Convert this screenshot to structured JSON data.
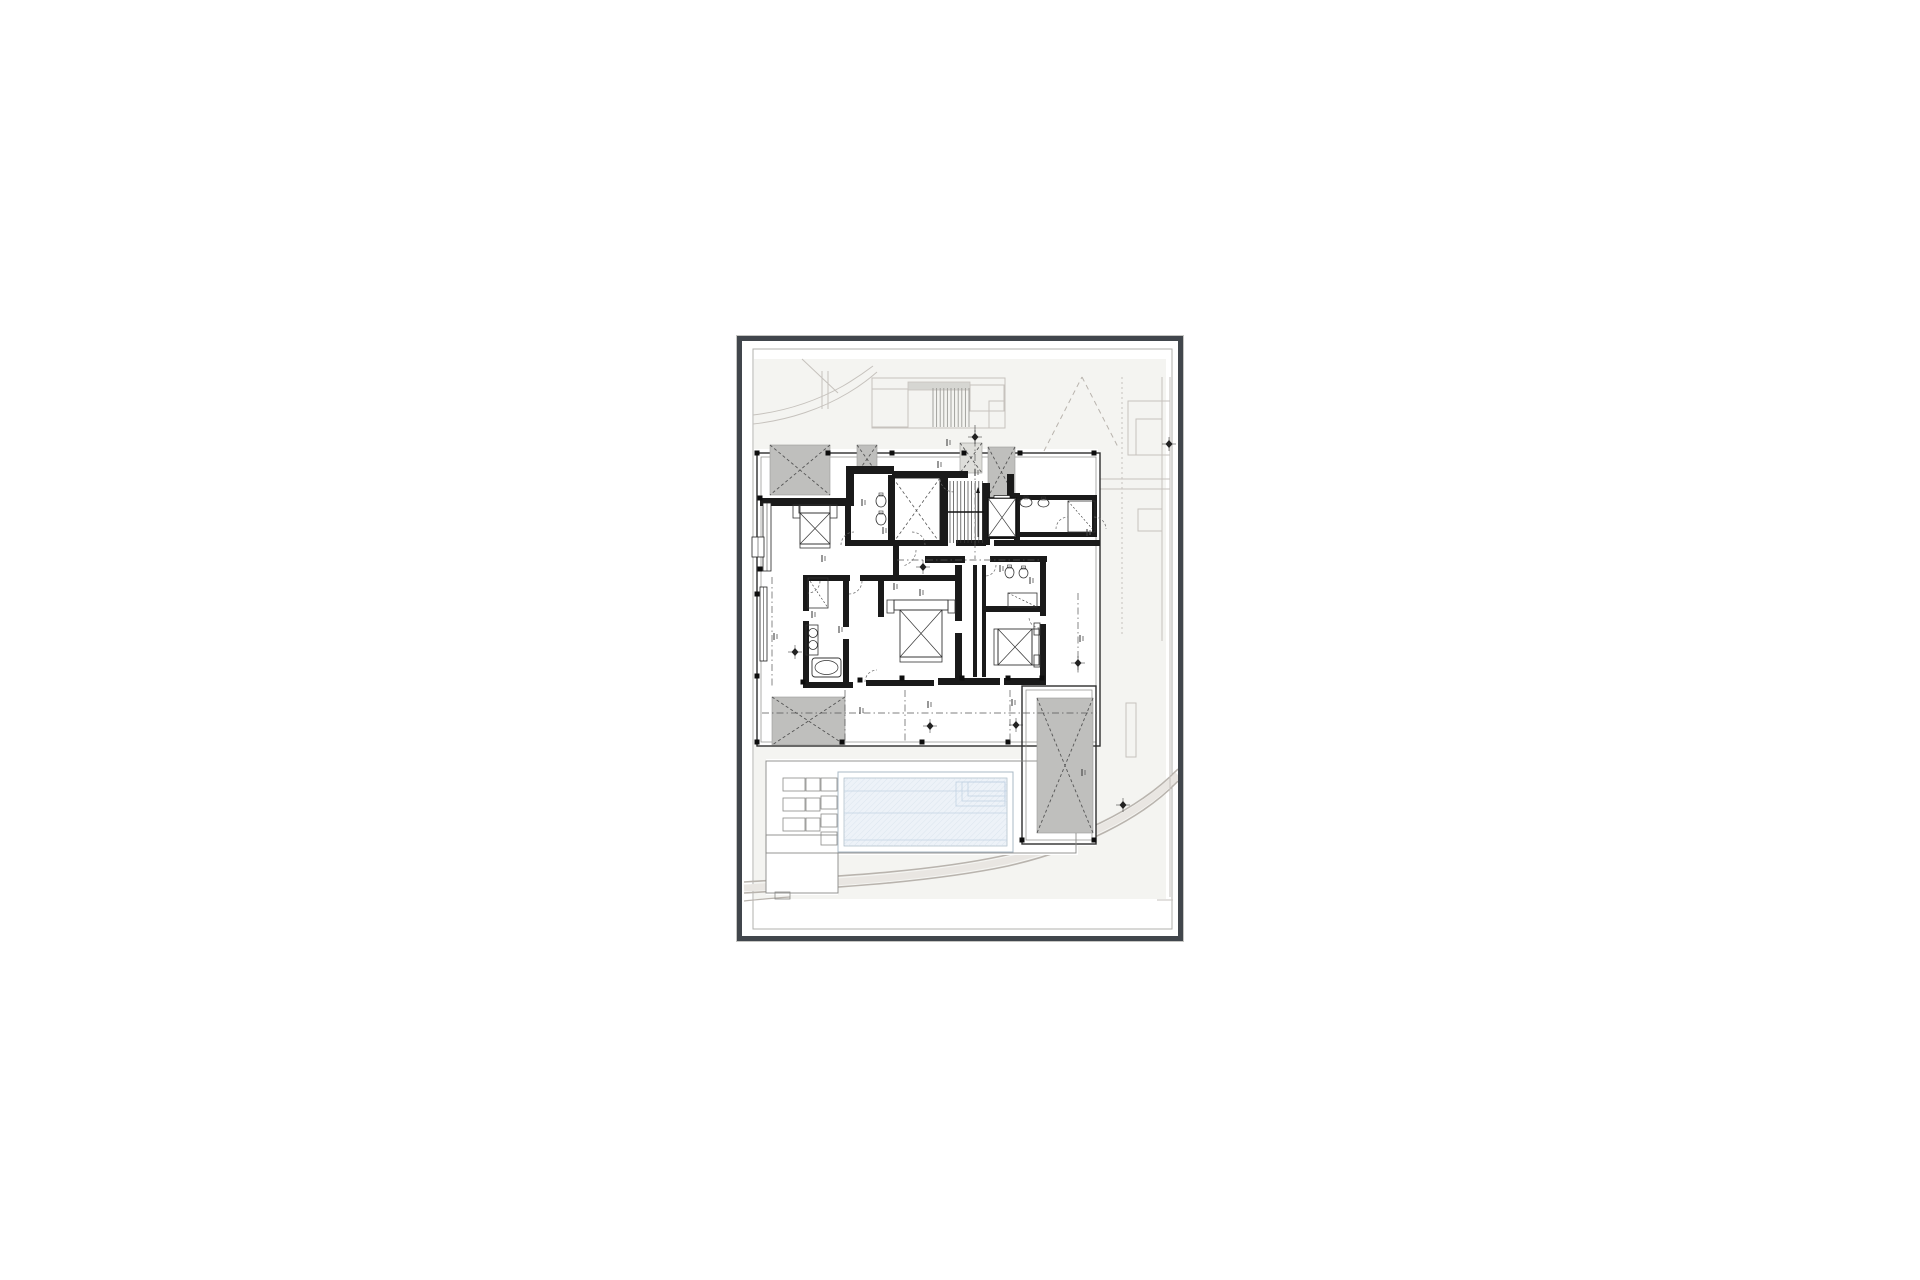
{
  "document": {
    "kind": "architectural floor plan drawing sheet",
    "visible_text_legible": false,
    "annotations_illegible": true
  },
  "palette": {
    "bg": "#ffffff",
    "frame": "#41464c",
    "inner_border": "#b0b0ae",
    "site_tint": "#f4f4f1",
    "site_line": "#c6c2bd",
    "road_fill": "#e9e6e2",
    "road_edge": "#b9b4ae",
    "wall": "#1a1a1a",
    "thin_dark": "#2e2e2e",
    "mid_line": "#8a8a88",
    "patch_gray": "#bfbfbd",
    "patch_light": "#dededa",
    "dash_color": "#555555",
    "pool_fill": "#edf2f8",
    "pool_line": "#c2d3e3",
    "pool_edge": "#a9b8c4",
    "fixture_line": "#333333"
  },
  "plan": {
    "frame": {
      "x": 737,
      "y": 336,
      "w": 446,
      "h": 605
    },
    "inner_border": [
      11,
      8,
      419,
      580
    ],
    "tint_rects": [
      [
        12,
        18,
        412,
        90
      ],
      [
        356,
        18,
        68,
        524
      ],
      [
        12,
        404,
        412,
        154
      ]
    ],
    "white_rects": [
      [
        15,
        112,
        343,
        293
      ],
      [
        280,
        345,
        74,
        160
      ],
      [
        24,
        418,
        312,
        96
      ],
      [
        24,
        494,
        72,
        60
      ]
    ],
    "roads": [
      {
        "d": "M2,541 C80,536 180,532 260,515 C330,500 395,470 436,428",
        "w": 1.6
      },
      {
        "d": "M2,552 C85,547 185,542 266,525 C336,509 400,478 436,440",
        "w": 1.6
      },
      {
        "d": "M2,547 C82,542 182,537 263,520 C333,504 397,474 436,434",
        "w": 7,
        "soft": true
      },
      {
        "d": "M2,560 C20,558 34,557 48,556",
        "w": 1.2
      }
    ],
    "drive_curves": [
      {
        "d": "M11,74 C45,70 76,59 101,45 C113,38 123,31 131,25"
      },
      {
        "d": "M11,83 C48,79 81,67 106,52 C118,45 127,38 135,31"
      },
      {
        "d": "M60,18 L96,52"
      }
    ],
    "site_lines": [
      {
        "x1": 380,
        "y1": 36,
        "x2": 380,
        "y2": 295,
        "dash": "2,3"
      },
      {
        "x1": 428,
        "y1": 36,
        "x2": 428,
        "y2": 556,
        "dash": ""
      },
      {
        "x1": 420,
        "y1": 36,
        "x2": 420,
        "y2": 300,
        "dash": ""
      },
      {
        "x1": 358,
        "y1": 138,
        "x2": 428,
        "y2": 138,
        "dash": ""
      },
      {
        "x1": 358,
        "y1": 148,
        "x2": 428,
        "y2": 148,
        "dash": ""
      },
      {
        "x1": 80,
        "y1": 30,
        "x2": 80,
        "y2": 68,
        "dash": ""
      },
      {
        "x1": 86,
        "y1": 30,
        "x2": 86,
        "y2": 68,
        "dash": ""
      },
      {
        "x1": 415,
        "y1": 559,
        "x2": 431,
        "y2": 559,
        "dash": ""
      }
    ],
    "dashed_v": [
      {
        "x1": 302,
        "y1": 110,
        "x2": 340,
        "y2": 36
      },
      {
        "x1": 340,
        "y1": 36,
        "x2": 377,
        "y2": 108
      }
    ],
    "site_rects": [
      [
        130,
        37,
        133,
        50
      ],
      [
        130,
        48,
        36,
        38
      ],
      [
        228,
        44,
        34,
        26
      ],
      [
        247,
        60,
        16,
        27
      ],
      [
        386,
        60,
        42,
        54
      ],
      [
        394,
        78,
        26,
        36
      ],
      [
        396,
        168,
        24,
        22
      ],
      [
        384,
        362,
        10,
        54
      ]
    ],
    "canopy": [
      166,
      41,
      62,
      8
    ],
    "entry_treads": {
      "x1": 191,
      "x2": 227,
      "step": 3.6,
      "y1": 47,
      "y2": 86
    },
    "envelope": [
      {
        "r": [
          15,
          112,
          343,
          293
        ],
        "w": 1.4,
        "c": "dark"
      },
      {
        "r": [
          19,
          116,
          335,
          285
        ],
        "w": 0.7,
        "c": "mid"
      },
      {
        "r": [
          280,
          345,
          74,
          158
        ],
        "w": 1.4,
        "c": "dark"
      },
      {
        "r": [
          284,
          349,
          66,
          150
        ],
        "w": 0.7,
        "c": "mid"
      },
      {
        "r": [
          24,
          420,
          310,
          92
        ],
        "w": 0.9,
        "c": "mid"
      },
      {
        "r": [
          24,
          494,
          72,
          58
        ],
        "w": 0.9,
        "c": "mid"
      },
      {
        "r": [
          33,
          551,
          15,
          7
        ],
        "w": 0.8,
        "c": "mid"
      }
    ],
    "patches": [
      {
        "r": [
          28,
          104,
          60,
          50
        ],
        "f": "gray"
      },
      {
        "r": [
          115,
          104,
          20,
          28
        ],
        "f": "gray"
      },
      {
        "r": [
          246,
          106,
          27,
          50
        ],
        "f": "gray"
      },
      {
        "r": [
          218,
          102,
          22,
          30
        ],
        "f": "light"
      },
      {
        "r": [
          30,
          356,
          73,
          48
        ],
        "f": "gray"
      },
      {
        "r": [
          295,
          357,
          56,
          135
        ],
        "f": "gray"
      }
    ],
    "lightwell": [
      151,
      137,
      47,
      65
    ],
    "walls": [
      [
        18,
        157,
        90,
        8
      ],
      [
        104,
        125,
        8,
        40
      ],
      [
        104,
        125,
        48,
        8
      ],
      [
        150,
        130,
        76,
        7
      ],
      [
        198,
        136,
        8,
        68
      ],
      [
        240,
        142,
        8,
        62
      ],
      [
        146,
        134,
        7,
        70
      ],
      [
        108,
        199,
        40,
        6
      ],
      [
        148,
        199,
        58,
        6
      ],
      [
        214,
        199,
        30,
        6
      ],
      [
        252,
        199,
        106,
        6
      ],
      [
        103,
        160,
        6,
        45
      ],
      [
        265,
        133,
        7,
        24
      ],
      [
        272,
        152,
        6,
        47
      ],
      [
        274,
        154,
        81,
        5
      ],
      [
        274,
        191,
        81,
        5
      ],
      [
        350,
        154,
        5,
        42
      ],
      [
        61,
        234,
        6,
        36
      ],
      [
        61,
        280,
        6,
        67
      ],
      [
        63,
        234,
        45,
        6
      ],
      [
        118,
        234,
        100,
        6
      ],
      [
        101,
        240,
        6,
        46
      ],
      [
        101,
        298,
        6,
        49
      ],
      [
        136,
        234,
        6,
        42
      ],
      [
        213,
        224,
        7,
        56
      ],
      [
        213,
        292,
        7,
        49
      ],
      [
        183,
        215,
        40,
        7
      ],
      [
        248,
        215,
        57,
        6
      ],
      [
        231,
        224,
        4,
        112
      ],
      [
        240,
        224,
        4,
        112
      ],
      [
        243,
        265,
        57,
        6
      ],
      [
        298,
        219,
        6,
        56
      ],
      [
        298,
        283,
        6,
        58
      ],
      [
        63,
        341,
        48,
        6
      ],
      [
        124,
        339,
        68,
        6
      ],
      [
        196,
        337,
        62,
        7
      ],
      [
        262,
        337,
        42,
        7
      ],
      [
        151,
        204,
        6,
        30
      ],
      [
        246,
        194,
        28,
        4
      ]
    ],
    "posts": [
      [
        15,
        112
      ],
      [
        86,
        112
      ],
      [
        150,
        112
      ],
      [
        222,
        112
      ],
      [
        278,
        112
      ],
      [
        352,
        112
      ],
      [
        15,
        401
      ],
      [
        100,
        401
      ],
      [
        180,
        401
      ],
      [
        266,
        401
      ],
      [
        280,
        499
      ],
      [
        352,
        499
      ],
      [
        18,
        157
      ],
      [
        18,
        228
      ],
      [
        61,
        341
      ],
      [
        118,
        339
      ],
      [
        160,
        337
      ],
      [
        220,
        337
      ],
      [
        266,
        337
      ],
      [
        300,
        337
      ],
      [
        15,
        253
      ],
      [
        15,
        335
      ]
    ],
    "windows": [
      [
        21,
        162,
        8,
        68
      ],
      [
        18,
        246,
        7,
        74
      ],
      [
        10,
        196,
        12,
        20
      ]
    ],
    "stairs": {
      "x": 206,
      "y": 140,
      "w": 36,
      "h": 62
    },
    "elevator": {
      "x": 246,
      "y": 157,
      "w": 28,
      "h": 39
    },
    "beds": [
      {
        "stands": [
          [
            51,
            164,
            7,
            13
          ],
          [
            88,
            164,
            7,
            13
          ]
        ],
        "band": [
          57,
          164,
          31,
          8
        ],
        "body": [
          58,
          172,
          30,
          31
        ],
        "foot": [
          58,
          203,
          30,
          4
        ]
      },
      {
        "stands": [
          [
            145,
            259,
            7,
            13
          ],
          [
            206,
            259,
            7,
            13
          ]
        ],
        "band": [
          152,
          259,
          54,
          10
        ],
        "body": [
          158,
          269,
          42,
          47
        ],
        "foot": [
          158,
          316,
          42,
          5
        ]
      },
      {
        "stands": [
          [
            292,
            282,
            6,
            12
          ],
          [
            292,
            314,
            6,
            12
          ]
        ],
        "band": [
          290,
          288,
          7,
          36
        ],
        "body": [
          256,
          288,
          34,
          36
        ],
        "foot": [
          252,
          288,
          4,
          36
        ]
      }
    ],
    "tub": [
      70,
      317,
      29,
      19
    ],
    "counter": [
      64,
      284,
      12,
      30
    ],
    "basins": [
      [
        71,
        292
      ],
      [
        71,
        304
      ]
    ],
    "wcs": [
      [
        134,
        154,
        10,
        12
      ],
      [
        134,
        172,
        10,
        12
      ],
      [
        278,
        157,
        12,
        9
      ],
      [
        296,
        158,
        11,
        8
      ],
      [
        263,
        226,
        9,
        11
      ],
      [
        277,
        227,
        9,
        10
      ]
    ],
    "showers": [
      [
        66,
        237,
        20,
        30
      ],
      [
        266,
        252,
        29,
        14
      ],
      [
        326,
        160,
        27,
        31
      ]
    ],
    "arcs": [
      {
        "x": 112,
        "y": 204,
        "r": 13,
        "a1": 180,
        "a2": 270
      },
      {
        "x": 170,
        "y": 204,
        "r": 13,
        "a1": 270,
        "a2": 360
      },
      {
        "x": 158,
        "y": 209,
        "r": 16,
        "a1": 0,
        "a2": 80
      },
      {
        "x": 107,
        "y": 240,
        "r": 13,
        "a1": 0,
        "a2": 90
      },
      {
        "x": 66,
        "y": 240,
        "r": 12,
        "a1": 0,
        "a2": 90
      },
      {
        "x": 212,
        "y": 137,
        "r": 14,
        "a1": 90,
        "a2": 180
      },
      {
        "x": 243,
        "y": 224,
        "r": 11,
        "a1": 0,
        "a2": 90
      },
      {
        "x": 135,
        "y": 341,
        "r": 12,
        "a1": 180,
        "a2": 270
      },
      {
        "x": 298,
        "y": 276,
        "r": 11,
        "a1": 90,
        "a2": 180
      },
      {
        "x": 326,
        "y": 188,
        "r": 12,
        "a1": 180,
        "a2": 270
      },
      {
        "x": 352,
        "y": 188,
        "r": 12,
        "a1": 270,
        "a2": 360
      }
    ],
    "dash_lines": [
      {
        "x1": 20,
        "y1": 372,
        "x2": 355,
        "y2": 372
      },
      {
        "x1": 233,
        "y1": 84,
        "x2": 233,
        "y2": 218
      },
      {
        "x1": 155,
        "y1": 219,
        "x2": 300,
        "y2": 219
      },
      {
        "x1": 30,
        "y1": 236,
        "x2": 30,
        "y2": 345
      },
      {
        "x1": 336,
        "y1": 252,
        "x2": 336,
        "y2": 332
      },
      {
        "x1": 103,
        "y1": 349,
        "x2": 103,
        "y2": 401
      },
      {
        "x1": 163,
        "y1": 349,
        "x2": 163,
        "y2": 401
      },
      {
        "x1": 268,
        "y1": 349,
        "x2": 268,
        "y2": 401
      }
    ],
    "diamonds": [
      [
        233,
        96
      ],
      [
        181,
        226
      ],
      [
        336,
        322
      ],
      [
        188,
        385
      ],
      [
        274,
        384
      ],
      [
        53,
        311
      ],
      [
        427,
        103
      ],
      [
        381,
        464
      ]
    ],
    "ticks": [
      [
        120,
        158
      ],
      [
        141,
        186
      ],
      [
        196,
        120
      ],
      [
        233,
        128
      ],
      [
        178,
        248
      ],
      [
        80,
        214
      ],
      [
        70,
        270
      ],
      [
        97,
        285
      ],
      [
        288,
        236
      ],
      [
        338,
        294
      ],
      [
        186,
        360
      ],
      [
        270,
        358
      ],
      [
        340,
        428
      ],
      [
        32,
        292
      ],
      [
        258,
        224
      ],
      [
        152,
        242
      ],
      [
        205,
        98
      ],
      [
        118,
        366
      ],
      [
        345,
        188
      ]
    ],
    "pool": {
      "outer": [
        96,
        431,
        175,
        80
      ],
      "water": [
        102,
        437,
        163,
        68
      ],
      "lanes": [
        450,
        472,
        499
      ],
      "steps": [
        [
          214,
          441,
          49,
          24
        ],
        [
          220,
          441,
          43,
          19
        ],
        [
          226,
          441,
          37,
          14
        ]
      ]
    },
    "loungers": {
      "rows": [
        [
          41,
          437
        ],
        [
          41,
          457
        ],
        [
          41,
          477
        ]
      ],
      "squares": [
        [
          79,
          437
        ],
        [
          79,
          455
        ],
        [
          79,
          473
        ],
        [
          79,
          491
        ]
      ]
    }
  }
}
